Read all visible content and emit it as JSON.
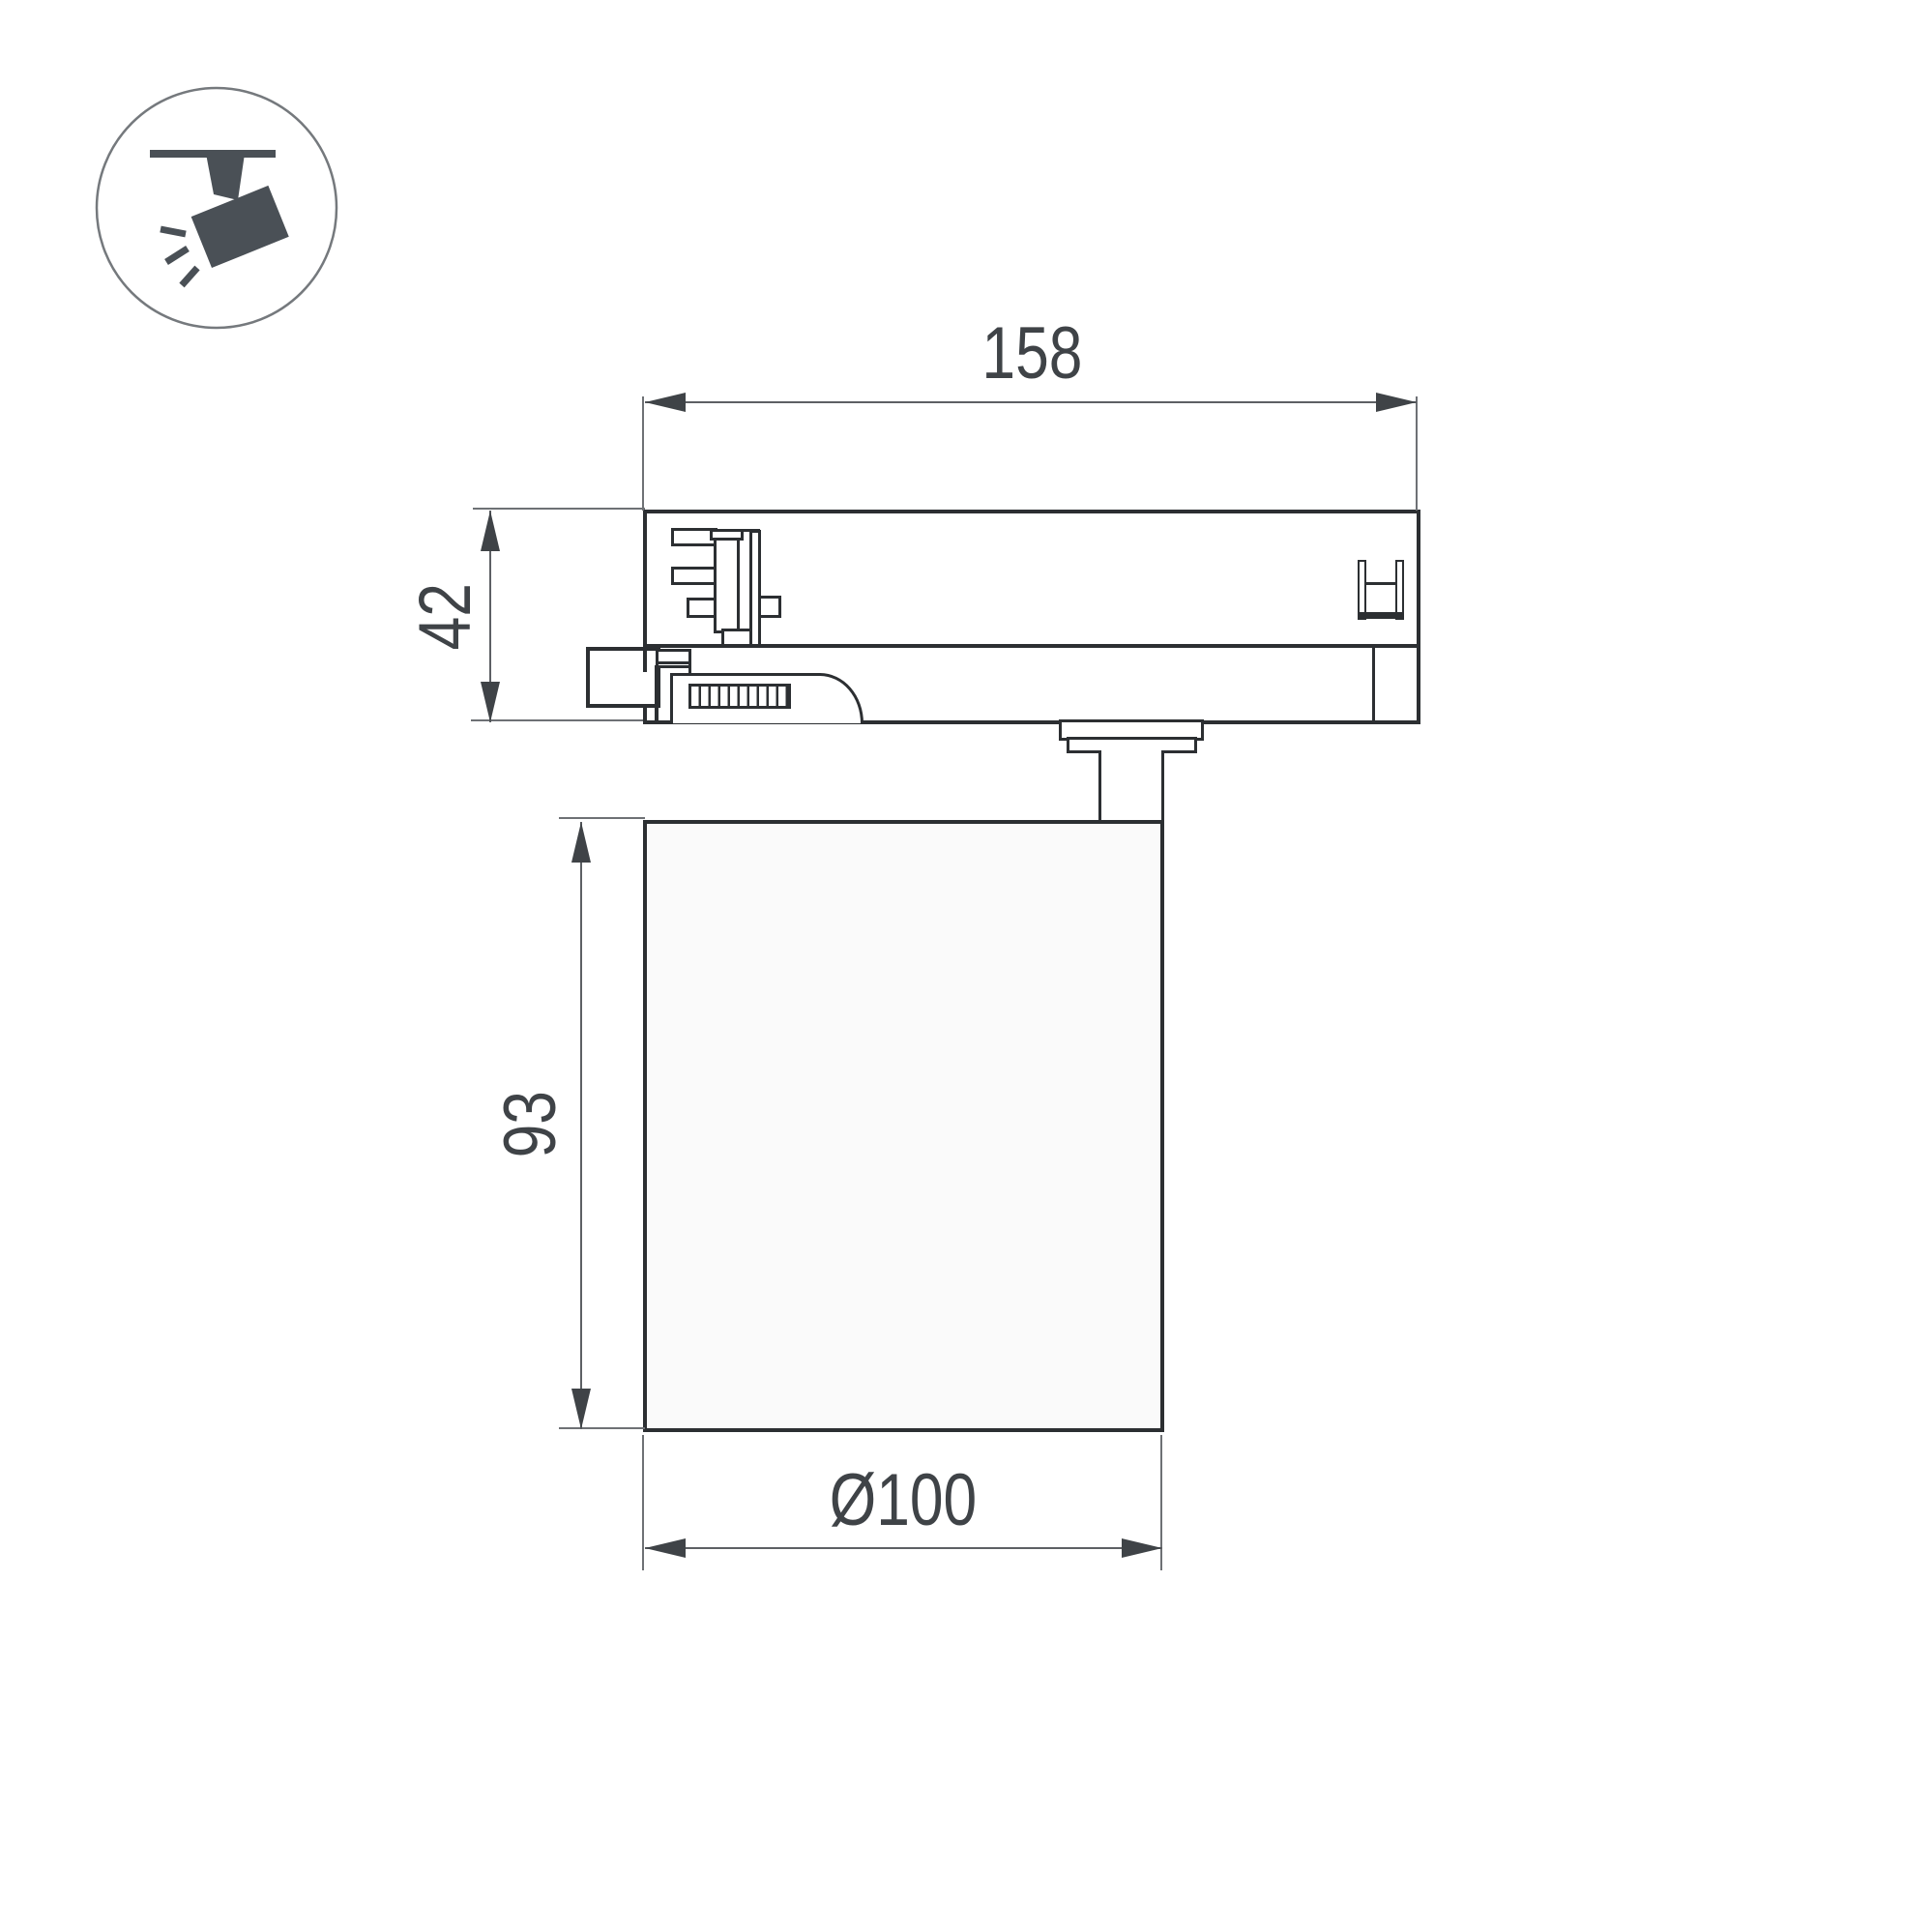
{
  "icon": {
    "name": "track-spotlight-icon"
  },
  "dimensions": {
    "adapter_width": "158",
    "adapter_height": "42",
    "body_height": "93",
    "body_diameter": "Ø100"
  },
  "colors": {
    "background": "#ffffff",
    "outline": "#2c2f32",
    "dimension_line": "#5d6064",
    "dimension_text": "#3f4347",
    "extension_line": "#6e7175",
    "icon": "#4a5056"
  }
}
